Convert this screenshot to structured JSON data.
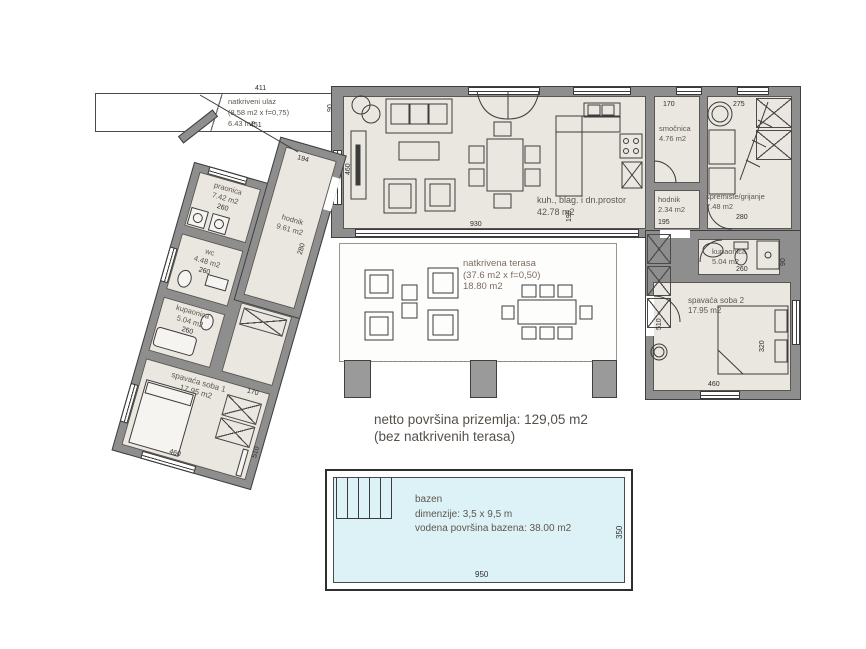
{
  "colors": {
    "wall": "#8e8e8e",
    "floor": "#eae7e1",
    "pool_water": "#ddf2f7",
    "label": "#5d564f",
    "line": "#3c3c3c"
  },
  "rooms": {
    "ulaz": {
      "name": "natkriveni ulaz",
      "factor": "(8.58 m2 x f=0,75)",
      "area": "6.43 m2"
    },
    "praonica": {
      "name": "praonica",
      "area": "7.42 m2"
    },
    "hodnik1": {
      "name": "hodnik",
      "area": "9.61 m2"
    },
    "wc": {
      "name": "wc",
      "area": "4.48 m2"
    },
    "kupaonica1": {
      "name": "kupaonica",
      "area": "5.04 m2"
    },
    "soba1": {
      "name": "spavaća soba 1",
      "area": "17.95 m2"
    },
    "living": {
      "name": "kuh., blag. i dn.prostor",
      "area": "42.78 m2"
    },
    "smocnica": {
      "name": "smočnica",
      "area": "4.76 m2"
    },
    "hodnik2": {
      "name": "hodnik",
      "area": "2.34 m2"
    },
    "spremiste": {
      "name": "spremište/grijanje",
      "area": "7.48 m2"
    },
    "kupaonica2": {
      "name": "kupaonica",
      "area": "5.04 m2"
    },
    "soba2": {
      "name": "spavaća soba 2",
      "area": "17.95 m2"
    },
    "terasa": {
      "name": "natkrivena terasa",
      "factor": "(37.6 m2 x f=0,50)",
      "area": "18.80 m2"
    }
  },
  "dims": {
    "ulaz_top": "411",
    "ulaz_bottom": "451",
    "ulaz_side": "90",
    "living_w": "930",
    "living_h": "460",
    "kitchen_w": "195",
    "smocnica_w": "170",
    "sprem_w": "275",
    "sprem_h": "280",
    "hodnik2_w": "195",
    "kup2_w": "260",
    "kup2_h": "90",
    "soba2_w": "460",
    "soba2_h": "320",
    "soba2_side": "510",
    "hodnik1_w": "194",
    "hodnik1_h": "280",
    "praonica_w": "260",
    "wc_w": "260",
    "kup1_w": "260",
    "soba1_w": "460",
    "soba1_h": "510",
    "soba1_door": "170",
    "pool_w": "950",
    "pool_h": "350"
  },
  "summary": {
    "line1": "netto površina prizemlja: 129,05 m2",
    "line2": "(bez natkrivenih terasa)"
  },
  "pool": {
    "name": "bazen",
    "dim_label": "dimenzije: 3,5 x 9,5 m",
    "area_label": "vodena površina bazena: 38.00 m2"
  }
}
